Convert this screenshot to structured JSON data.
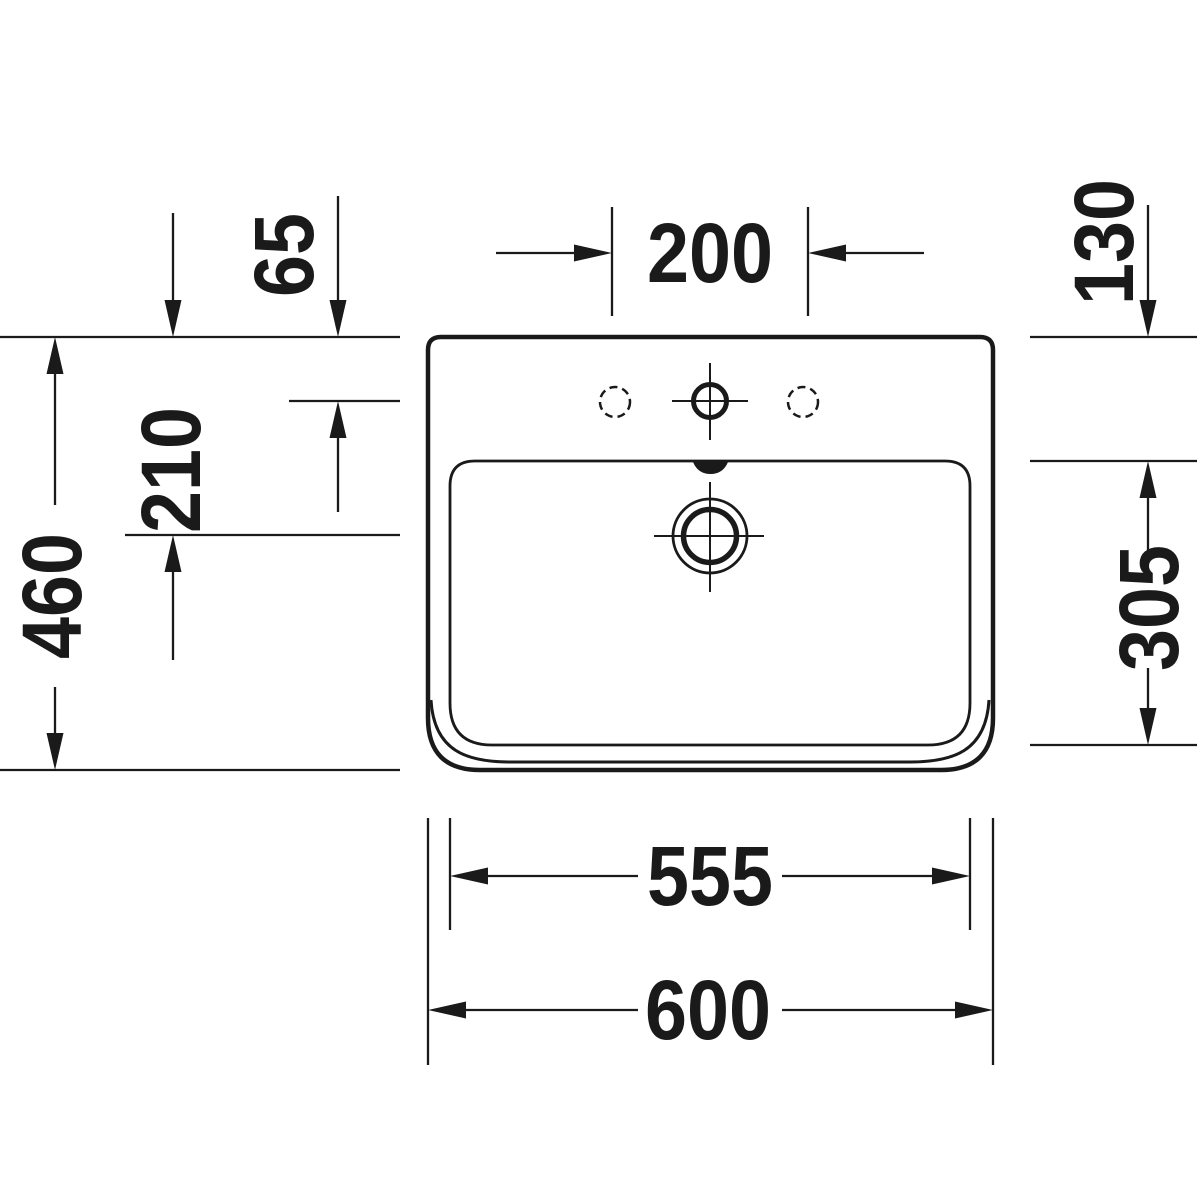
{
  "diagram": {
    "subject": "Washbasin technical drawing, top view",
    "units": "mm",
    "ink_color": "#1a1a1a",
    "background_color": "#ffffff"
  },
  "labels": {
    "faucet_spacing": "200",
    "rim_to_faucet_axis": "65",
    "rim_to_drain_axis": "210",
    "overall_depth": "460",
    "rim_to_bowl_front": "130",
    "bowl_depth": "305",
    "bowl_width": "555",
    "overall_width": "600"
  },
  "values_mm": {
    "faucet_spacing": 200,
    "rim_to_faucet_axis": 65,
    "rim_to_drain_axis": 210,
    "overall_depth": 460,
    "rim_to_bowl_front": 130,
    "bowl_depth": 305,
    "bowl_width": 555,
    "overall_width": 600
  }
}
